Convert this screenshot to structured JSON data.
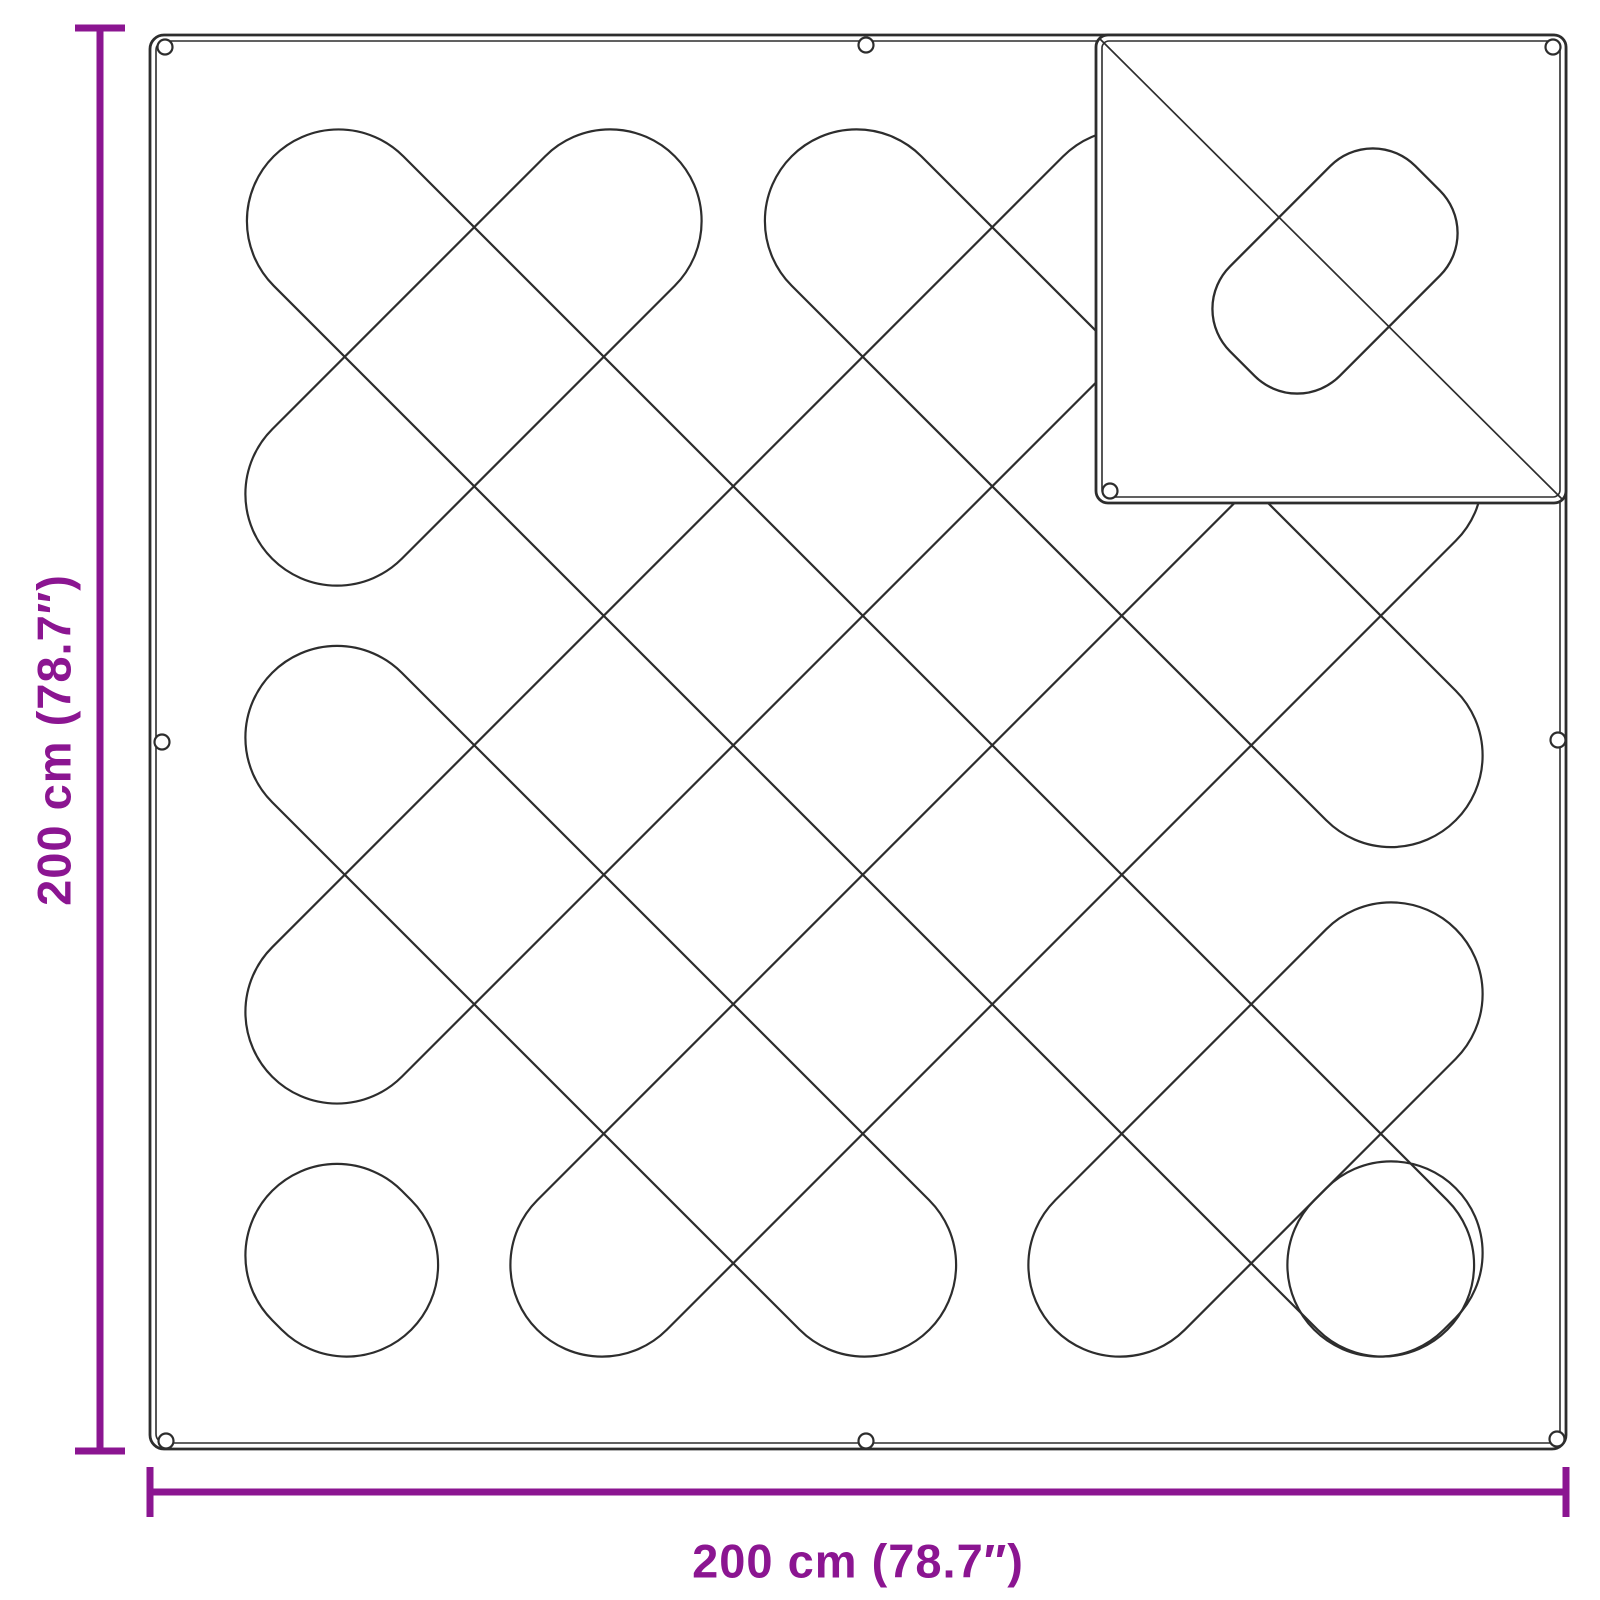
{
  "page": {
    "background": "#ffffff",
    "width": 1600,
    "height": 1600
  },
  "dimensions": {
    "accent_color": "#8B1591",
    "height_label": "200 cm (78.7″)",
    "width_label": "200 cm (78.7″)",
    "line_thickness": 7,
    "cap_length": 50,
    "vertical": {
      "x": 100,
      "y1": 28,
      "y2": 1451,
      "label_x": 54,
      "label_y": 740
    },
    "horizontal": {
      "y": 1492,
      "x1": 150,
      "x2": 1566,
      "label_x": 858,
      "label_y": 1561
    }
  },
  "drawing": {
    "stroke_color": "#2D2D2D",
    "fill_color": "#FFFFFF",
    "blanket": {
      "x": 150,
      "y": 35,
      "w": 1416,
      "h": 1414,
      "r": 14,
      "inner_offset": 6,
      "outer_stroke": 2.8,
      "inner_stroke": 1.6
    },
    "quilt": {
      "stroke_width": 2.2,
      "capsule_width": 183.2,
      "corner_radius": 91.6,
      "capsules": [
        {
          "cx": 860.5,
          "cy": 743,
          "len": 1659.6,
          "angle": 45
        },
        {
          "cx": 1123.75,
          "cy": 488.25,
          "len": 939.1,
          "angle": 45
        },
        {
          "cx": 600.75,
          "cy": 1001.25,
          "len": 929.2,
          "angle": 45
        },
        {
          "cx": 341.75,
          "cy": 1260.25,
          "len": 196.6,
          "angle": 45
        },
        {
          "cx": 473.5,
          "cy": 357.5,
          "len": 569.3,
          "angle": -45
        },
        {
          "cx": 732.5,
          "cy": 616.5,
          "len": 1301.8,
          "angle": -45
        },
        {
          "cx": 996.5,
          "cy": 870.5,
          "len": 1299.0,
          "angle": -45
        },
        {
          "cx": 1255.5,
          "cy": 1129.5,
          "len": 566.5,
          "angle": -45
        },
        {
          "cx": 1385,
          "cy": 1259,
          "len": 200.2,
          "angle": -45
        }
      ]
    },
    "inset": {
      "x": 1096,
      "y": 35,
      "w": 470,
      "h": 468,
      "r": 12,
      "diagonal": {
        "x1": 1100,
        "y1": 39,
        "x2": 1562,
        "y2": 499,
        "stroke_width": 1.7
      },
      "diamond": {
        "cx": 1335,
        "cy": 271,
        "w": 155,
        "h": 262,
        "rx": 60,
        "angle": 45,
        "stroke_width": 2.3
      },
      "grommets": [
        [
          1553,
          47
        ],
        [
          1110,
          491
        ]
      ]
    },
    "grommets": {
      "radius": 7.5,
      "stroke_width": 2.2,
      "points": [
        [
          165,
          47
        ],
        [
          866,
          45
        ],
        [
          162,
          742
        ],
        [
          1558,
          740
        ],
        [
          166,
          1441
        ],
        [
          866,
          1441
        ],
        [
          1557,
          1439
        ]
      ]
    }
  }
}
